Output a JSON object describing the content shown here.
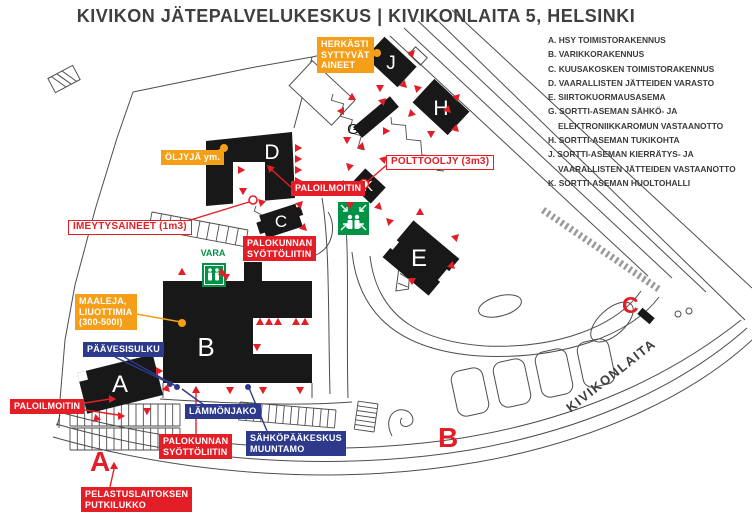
{
  "title": "KIVIKON JÄTEPALVELUKESKUS | KIVIKONLAITA 5, HELSINKI",
  "legend": {
    "items": [
      "A. HSY TOIMISTORAKENNUS",
      "B. VARIKKORAKENNUS",
      "C. KUUSAKOSKEN TOIMISTORAKENNUS",
      "D. VAARALLISTEN JÄTTEIDEN VARASTO",
      "E. SIIRTOKUORMAUSASEMA",
      "G. SORTTI-ASEMAN SÄHKÖ- JA",
      "ELEKTRONIIKKAROMUN VASTAANOTTO",
      "H. SORTTI-ASEMAN TUKIKOHTA",
      "J. SORTTI-ASEMAN KIERRÄTYS- JA",
      "VAARALLISTEN JÄTTEIDEN VASTAANOTTO",
      "K. SORTTI-ASEMAN HUOLTOHALLI"
    ]
  },
  "labels": {
    "herkasti": "HERKÄSTI\nSYTTYVÄT\nAINEET",
    "oljyja": "ÖLJYJÄ ym.",
    "maaleja": "MAALEJA,\nLIUOTTIMIA\n(300-500l)",
    "paloilmoitin_top": "PALOILMOITIN",
    "palokunnan_c": "PALOKUNNAN\nSYÖTTÖLIITIN",
    "polttooljy": "POLTTOÖLJY (3m3)",
    "imeytysaineet": "IMEYTYSAINEET (1m3)",
    "paavesisulku": "PÄÄVESISULKU",
    "lammonjako": "LÄMMÖNJAKO",
    "sahkopaakeskus": "SÄHKÖPÄÄKESKUS\nMUUNTAMO",
    "paloilmoitin_bottom": "PALOILMOITIN",
    "palokunnan_bottom": "PALOKUNNAN\nSYÖTTÖLIITIN",
    "pelastuslaitoksen": "PELASTUSLAITOKSEN\nPUTKILUKKO",
    "vara": "VARA"
  },
  "buildings": {
    "a": "A",
    "b": "B",
    "c": "C",
    "d": "D",
    "e": "E",
    "g": "G",
    "h": "H",
    "j": "J",
    "k": "K"
  },
  "markers": {
    "a": "A",
    "b": "B",
    "c": "C"
  },
  "street_name": "KIVIKONLAITA",
  "colors": {
    "red": "#e31e26",
    "orange": "#f59e17",
    "blue": "#2d3a8c",
    "green": "#009245",
    "building_black": "#181818",
    "map_line": "#4d4d4d",
    "text_gray": "#3f3f3f"
  }
}
